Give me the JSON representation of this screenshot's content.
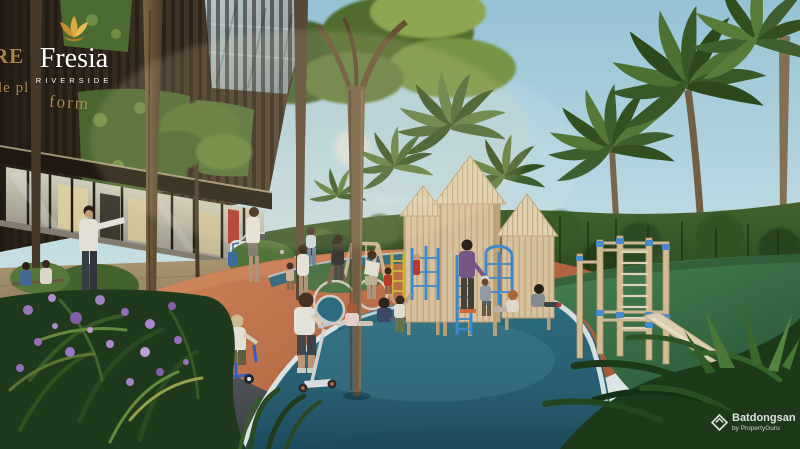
{
  "branding": {
    "project_name": "Fresia",
    "project_subtitle": "RIVERSIDE",
    "flower_icon": "gold-flower-logo",
    "facade_fragments": [
      "RE",
      "le pl",
      "form"
    ]
  },
  "watermark": {
    "logo_icon": "batdongsan-chevron-logo",
    "name": "Batdongsan",
    "byline": "by PropertyGuru"
  },
  "scene": {
    "setting": "Sunny architectural rendering of the Fresia Riverside residential project: a landscaped playground with curved running tracks beside a dark timber apartment tower with vertical gardens",
    "elements": [
      "sky",
      "palm-trees",
      "tree-canopy",
      "apartment-building",
      "vertical-garden",
      "retail-storefront",
      "red-banner",
      "white-car",
      "paved-walkway",
      "asphalt-bike-path",
      "orange-track",
      "blue-track",
      "green-rubber-surface",
      "wooden-playhouses",
      "swing-set",
      "blue-climbing-frames",
      "yellow-ladder",
      "calisthenics-rig",
      "incline-board",
      "children-on-scooters",
      "children-sitting",
      "adults-walking",
      "purple-flower-bush",
      "foreground-foliage"
    ]
  },
  "colors": {
    "sky_top": "#9ecbdf",
    "sky_horizon": "#ecf3e9",
    "building_dark": "#32281e",
    "gold_accent": "#c39a52",
    "logo_gold": "#dcab3f",
    "track_orange": "#c86f46",
    "track_blue": "#2e6f85",
    "rubber_green": "#3d7a50",
    "asphalt_gray": "#54585c",
    "wood_light": "#e0c9a2",
    "play_blue": "#3f8fd4",
    "play_yellow": "#d8b93c",
    "foliage_dark": "#1e3a1a",
    "flower_purple": "#9b72c4"
  }
}
